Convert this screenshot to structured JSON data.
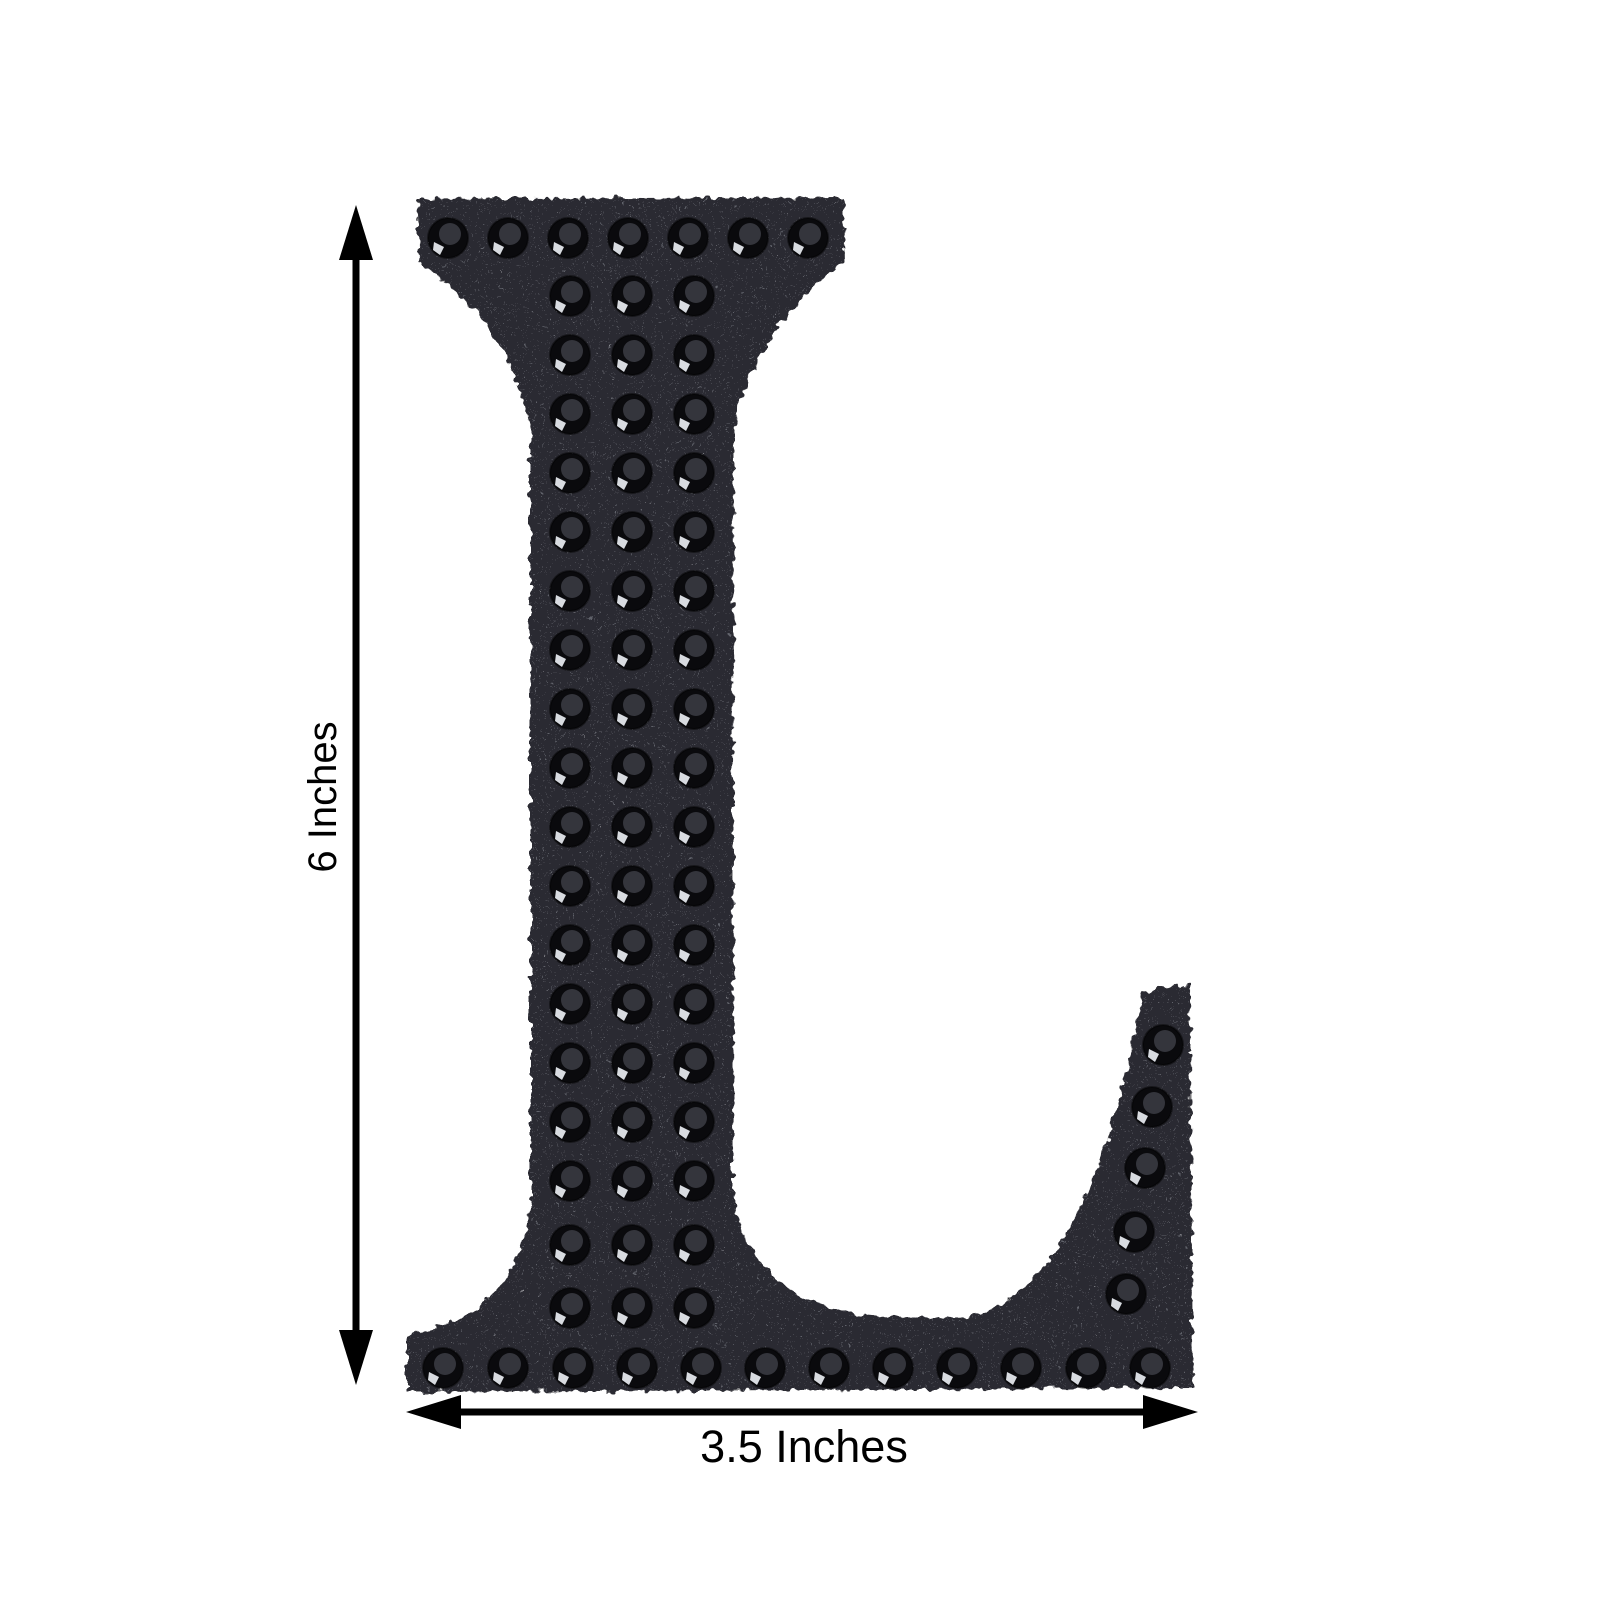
{
  "page": {
    "background": "#ffffff"
  },
  "product": {
    "letter": "L",
    "description": "Black glitter rhinestone self-adhesive letter L",
    "colors": {
      "glitter_base": "#2c2c31",
      "glitter_speckle": "#8a8e98",
      "glitter_sparkle": "#e9ecf1",
      "stone_outer": "#0a0a0d",
      "stone_inner": "#34353c",
      "stone_glint": "#d8dbe0",
      "annotation": "#000000"
    },
    "stones": [
      [
        448,
        238
      ],
      [
        508,
        238
      ],
      [
        568,
        238
      ],
      [
        628,
        238
      ],
      [
        688,
        238
      ],
      [
        748,
        238
      ],
      [
        808,
        238
      ],
      [
        570,
        296
      ],
      [
        632,
        296
      ],
      [
        694,
        296
      ],
      [
        570,
        355
      ],
      [
        632,
        355
      ],
      [
        694,
        355
      ],
      [
        570,
        414
      ],
      [
        632,
        414
      ],
      [
        694,
        414
      ],
      [
        570,
        473
      ],
      [
        632,
        473
      ],
      [
        694,
        473
      ],
      [
        570,
        532
      ],
      [
        632,
        532
      ],
      [
        694,
        532
      ],
      [
        570,
        591
      ],
      [
        632,
        591
      ],
      [
        694,
        591
      ],
      [
        570,
        650
      ],
      [
        632,
        650
      ],
      [
        694,
        650
      ],
      [
        570,
        709
      ],
      [
        632,
        709
      ],
      [
        694,
        709
      ],
      [
        570,
        768
      ],
      [
        632,
        768
      ],
      [
        694,
        768
      ],
      [
        570,
        827
      ],
      [
        632,
        827
      ],
      [
        694,
        827
      ],
      [
        570,
        886
      ],
      [
        632,
        886
      ],
      [
        694,
        886
      ],
      [
        570,
        945
      ],
      [
        632,
        945
      ],
      [
        694,
        945
      ],
      [
        570,
        1004
      ],
      [
        632,
        1004
      ],
      [
        694,
        1004
      ],
      [
        570,
        1063
      ],
      [
        632,
        1063
      ],
      [
        694,
        1063
      ],
      [
        570,
        1122
      ],
      [
        632,
        1122
      ],
      [
        694,
        1122
      ],
      [
        570,
        1181
      ],
      [
        632,
        1181
      ],
      [
        694,
        1181
      ],
      [
        570,
        1245
      ],
      [
        632,
        1245
      ],
      [
        694,
        1245
      ],
      [
        570,
        1308
      ],
      [
        632,
        1308
      ],
      [
        694,
        1308
      ],
      [
        443,
        1368
      ],
      [
        508,
        1368
      ],
      [
        573,
        1368
      ],
      [
        637,
        1368
      ],
      [
        701,
        1368
      ],
      [
        765,
        1368
      ],
      [
        829,
        1368
      ],
      [
        893,
        1368
      ],
      [
        957,
        1368
      ],
      [
        1021,
        1368
      ],
      [
        1086,
        1368
      ],
      [
        1150,
        1368
      ],
      [
        1163,
        1045
      ],
      [
        1152,
        1107
      ],
      [
        1145,
        1168
      ],
      [
        1134,
        1232
      ],
      [
        1126,
        1294
      ]
    ]
  },
  "dimensions": {
    "height_label": "6 Inches",
    "width_label": "3.5 Inches"
  }
}
